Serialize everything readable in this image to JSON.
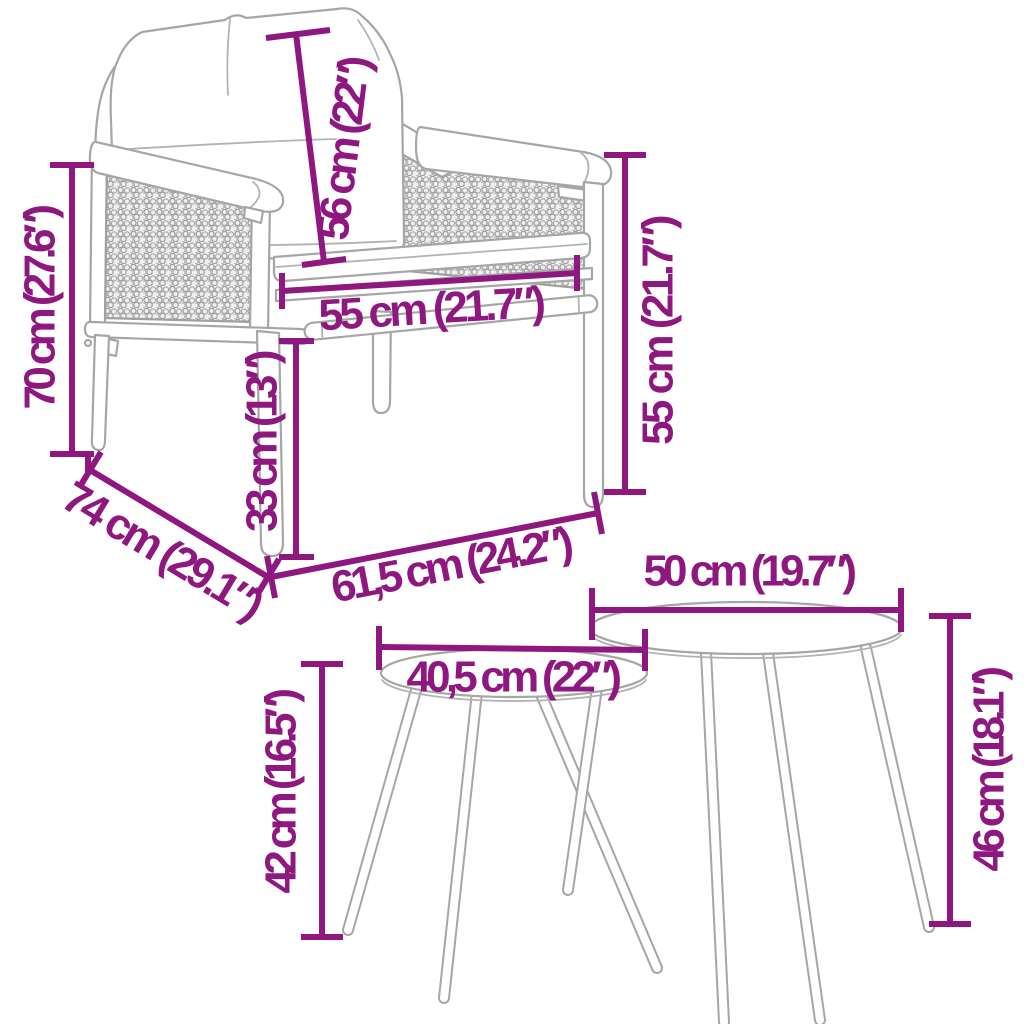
{
  "page": {
    "type": "product-dimension-diagram",
    "background": "#ffffff",
    "accent_color": "#8E187F",
    "artwork_line_color": "#a6a6a6",
    "items": [
      "garden armchair with cushions",
      "small round side table",
      "large round side table"
    ]
  },
  "dims": {
    "chair_height": "70 cm (27.6″)",
    "back_cushion_height": "56 cm (22″)",
    "seat_width": "55 cm (21.7″)",
    "seat_height": "33 cm (13″)",
    "chair_depth": "74 cm (29.1″)",
    "chair_width": "61,5 cm (24.2″)",
    "backrest_height": "55 cm (21.7″)",
    "large_table_diameter": "50 cm (19.7″)",
    "small_table_diameter": "40,5 cm (22″)",
    "small_table_height": "42 cm (16.5″)",
    "large_table_height": "46 cm (18.1″)"
  },
  "annotations": [
    {
      "id": "chair-height",
      "target": "armchair",
      "label": "70 cm (27.6″)",
      "orientation": "vertical-left"
    },
    {
      "id": "back-cushion-height",
      "target": "armchair back cushion",
      "label": "56 cm (22″)",
      "orientation": "slanted-vertical"
    },
    {
      "id": "seat-width",
      "target": "armchair seat",
      "label": "55 cm (21.7″)",
      "orientation": "horizontal"
    },
    {
      "id": "seat-height",
      "target": "armchair seat height",
      "label": "33 cm (13″)",
      "orientation": "vertical"
    },
    {
      "id": "chair-depth",
      "target": "armchair depth",
      "label": "74 cm (29.1″)",
      "orientation": "diagonal"
    },
    {
      "id": "chair-width",
      "target": "armchair width",
      "label": "61,5 cm (24.2″)",
      "orientation": "diagonal"
    },
    {
      "id": "backrest-height",
      "target": "armchair backrest",
      "label": "55 cm (21.7″)",
      "orientation": "vertical-right"
    },
    {
      "id": "large-table-diameter",
      "target": "large table top",
      "label": "50 cm (19.7″)",
      "orientation": "horizontal"
    },
    {
      "id": "small-table-diameter",
      "target": "small table top",
      "label": "40,5 cm (22″)",
      "orientation": "horizontal"
    },
    {
      "id": "small-table-height",
      "target": "small table",
      "label": "42 cm (16.5″)",
      "orientation": "vertical-left"
    },
    {
      "id": "large-table-height",
      "target": "large table",
      "label": "46 cm (18.1″)",
      "orientation": "vertical-right"
    }
  ]
}
